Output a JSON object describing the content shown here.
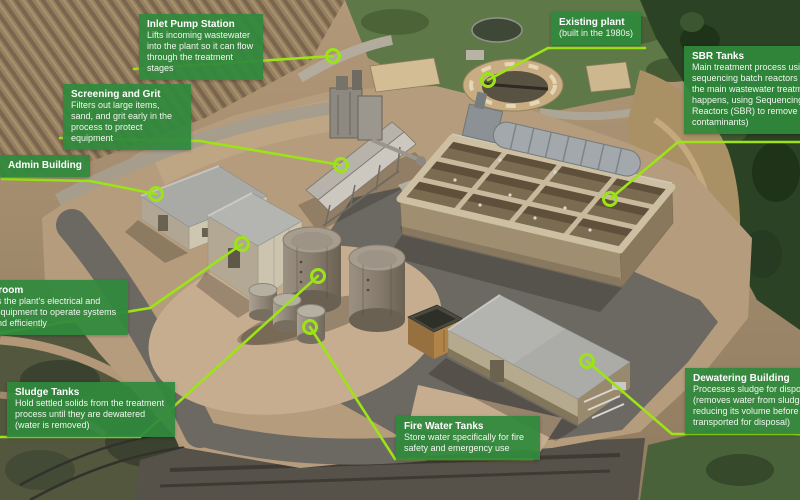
{
  "colors": {
    "callout_bg": "#2f8a3c",
    "leader_line": "#9ce317",
    "marker_ring": "#9ce317"
  },
  "callouts": {
    "inlet_pump_station": {
      "title": "Inlet Pump Station",
      "body": "Lifts incoming wastewater into the plant so it can flow through the treatment stages"
    },
    "screening_and_grit": {
      "title": "Screening and Grit",
      "body": "Filters out large items, sand, and grit early in the process to protect equipment"
    },
    "admin_building": {
      "title": "Admin Building",
      "body": ""
    },
    "switchroom": {
      "title": "Switchroom",
      "body": "Contains the plant's electrical and control equipment to operate systems safely and efficiently"
    },
    "sludge_tanks": {
      "title": "Sludge Tanks",
      "body": "Hold settled solids from the treatment process until they are dewatered (water is removed)"
    },
    "fire_water_tanks": {
      "title": "Fire Water Tanks",
      "body": "Store water specifically for fire safety and emergency use"
    },
    "existing_plant": {
      "title": "Existing plant",
      "body": "(built in the 1980s)"
    },
    "sbr_tanks": {
      "title": "SBR Tanks",
      "body": "Main treatment process using sequencing batch reactors (where the main wastewater treatment happens, using Sequencing Batch Reactors (SBR) to remove contaminants)"
    },
    "dewatering_building": {
      "title": "Dewatering Building",
      "body": "Processes sludge for disposal (removes water from sludge, reducing its volume before it's transported for disposal)"
    }
  }
}
